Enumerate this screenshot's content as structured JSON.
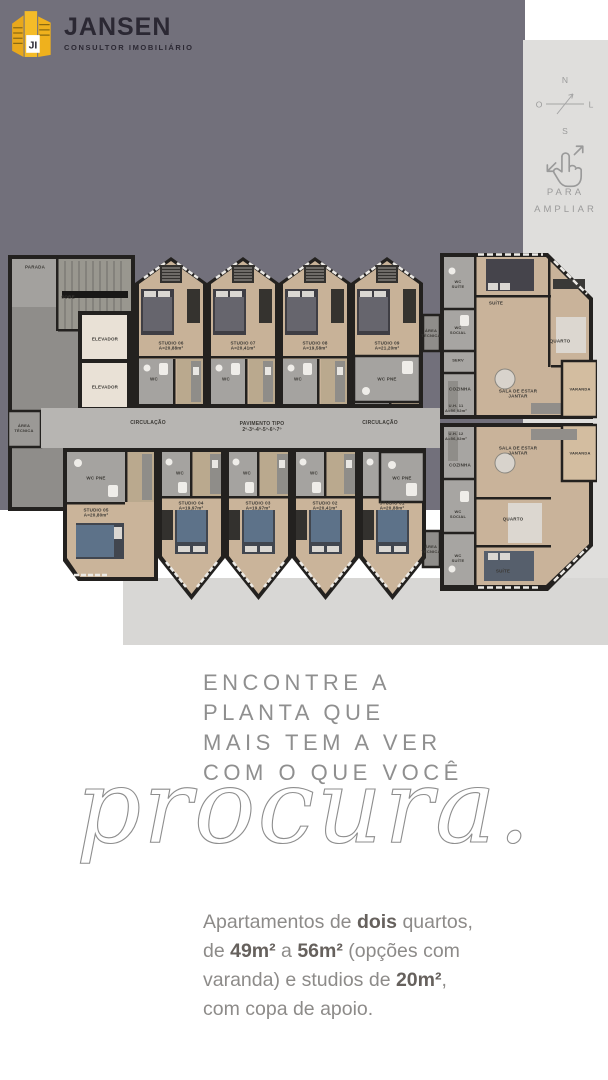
{
  "logo": {
    "brand": "JANSEN",
    "tagline": "CONSULTOR IMOBILIÁRIO",
    "monogram": "JI",
    "accent": "#f2b01e",
    "text_color": "#2b2833"
  },
  "sidebar": {
    "compass_n": "N",
    "compass_s": "S",
    "compass_w": "O",
    "compass_e": "L",
    "hint1": "PARA",
    "hint2": "AMPLIAR"
  },
  "headline": {
    "line1": "ENCONTRE A",
    "line2": "PLANTA QUE",
    "line3": "MAIS TEM A VER",
    "line4": "COM O QUE VOCÊ",
    "script": "procura."
  },
  "paragraph": {
    "p1a": "Apartamentos de ",
    "p1b": "dois",
    "p1c": " quartos,",
    "p2a": "de ",
    "p2b": "49m²",
    "p2c": " a ",
    "p2d": "56m²",
    "p2e": " (opções com",
    "p3a": "varanda) e studios de ",
    "p3b": "20m²",
    "p3c": ",",
    "p4": "com copa de apoio."
  },
  "plan": {
    "labels": [
      {
        "t": "PARADA",
        "x": 27,
        "y": 16,
        "fs": 4.5
      },
      {
        "t": "SOBE",
        "x": 60,
        "y": 46,
        "fs": 4.5
      },
      {
        "t": "ELEVADOR",
        "x": 97,
        "y": 88,
        "fs": 4.5
      },
      {
        "t": "ELEVADOR",
        "x": 97,
        "y": 136,
        "fs": 4.5
      },
      {
        "t": "ÁREA\nTÉCNICA",
        "x": 16,
        "y": 178,
        "fs": 4
      },
      {
        "t": "CIRCULAÇÃO",
        "x": 140,
        "y": 172,
        "fs": 5
      },
      {
        "t": "PAVIMENTO TIPO\n2º-3º-4º-5º-6º-7º",
        "x": 254,
        "y": 176,
        "fs": 5
      },
      {
        "t": "CIRCULAÇÃO",
        "x": 372,
        "y": 172,
        "fs": 5
      },
      {
        "t": "STUDIO 06\nA=20,88m²",
        "x": 163,
        "y": 95,
        "fs": 4.5
      },
      {
        "t": "STUDIO 07\nA=20,41m²",
        "x": 235,
        "y": 95,
        "fs": 4.5
      },
      {
        "t": "STUDIO 08\nA=19,58m²",
        "x": 307,
        "y": 95,
        "fs": 4.5
      },
      {
        "t": "STUDIO 09\nA=21,20m²",
        "x": 379,
        "y": 95,
        "fs": 4.5
      },
      {
        "t": "WC",
        "x": 146,
        "y": 128,
        "fs": 4.5
      },
      {
        "t": "WC",
        "x": 218,
        "y": 128,
        "fs": 4.5
      },
      {
        "t": "WC",
        "x": 290,
        "y": 128,
        "fs": 4.5
      },
      {
        "t": "WC PNE",
        "x": 379,
        "y": 128,
        "fs": 4.5
      },
      {
        "t": "ÁREA\nTÉCNICA",
        "x": 423,
        "y": 83,
        "fs": 4
      },
      {
        "t": "ÁREA\nTÉCNICA",
        "x": 423,
        "y": 299,
        "fs": 4
      },
      {
        "t": "WC PNE",
        "x": 88,
        "y": 227,
        "fs": 4.5
      },
      {
        "t": "STUDIO 05\nA=20,80m²",
        "x": 88,
        "y": 262,
        "fs": 4.5
      },
      {
        "t": "WC",
        "x": 172,
        "y": 222,
        "fs": 4.5
      },
      {
        "t": "WC",
        "x": 239,
        "y": 222,
        "fs": 4.5
      },
      {
        "t": "WC",
        "x": 306,
        "y": 222,
        "fs": 4.5
      },
      {
        "t": "WC PNE",
        "x": 394,
        "y": 227,
        "fs": 4.5
      },
      {
        "t": "STUDIO 04\nA=19,97m²",
        "x": 183,
        "y": 255,
        "fs": 4.5
      },
      {
        "t": "STUDIO 03\nA=19,97m²",
        "x": 250,
        "y": 255,
        "fs": 4.5
      },
      {
        "t": "STUDIO 02\nA=20,41m²",
        "x": 317,
        "y": 255,
        "fs": 4.5
      },
      {
        "t": "STUDIO 01\nA=20,88m²",
        "x": 384,
        "y": 255,
        "fs": 4.5
      },
      {
        "t": "WC\nSUÍTE",
        "x": 450,
        "y": 34,
        "fs": 4
      },
      {
        "t": "WC\nSOCIAL",
        "x": 450,
        "y": 80,
        "fs": 4
      },
      {
        "t": "SERV",
        "x": 450,
        "y": 110,
        "fs": 4
      },
      {
        "t": "COZINHA",
        "x": 452,
        "y": 138,
        "fs": 4.5
      },
      {
        "t": "SUÍTE",
        "x": 488,
        "y": 52,
        "fs": 4.5
      },
      {
        "t": "QUARTO",
        "x": 552,
        "y": 90,
        "fs": 4.5
      },
      {
        "t": "SALA DE ESTAR\nJANTAR",
        "x": 510,
        "y": 143,
        "fs": 4.5
      },
      {
        "t": "VARANDA",
        "x": 572,
        "y": 139,
        "fs": 4
      },
      {
        "t": "U.H. 11\nA=56,02m²",
        "x": 448,
        "y": 158,
        "fs": 4
      },
      {
        "t": "U.H. 12\nA=56,02m²",
        "x": 448,
        "y": 186,
        "fs": 4
      },
      {
        "t": "SALA DE ESTAR\nJANTAR",
        "x": 510,
        "y": 200,
        "fs": 4.5
      },
      {
        "t": "VARANDA",
        "x": 572,
        "y": 203,
        "fs": 4
      },
      {
        "t": "COZINHA",
        "x": 452,
        "y": 214,
        "fs": 4.5
      },
      {
        "t": "WC\nSOCIAL",
        "x": 450,
        "y": 264,
        "fs": 4
      },
      {
        "t": "WC\nSUÍTE",
        "x": 450,
        "y": 308,
        "fs": 4
      },
      {
        "t": "QUARTO",
        "x": 505,
        "y": 268,
        "fs": 4.5
      },
      {
        "t": "SUÍTE",
        "x": 495,
        "y": 320,
        "fs": 4.5
      }
    ]
  }
}
